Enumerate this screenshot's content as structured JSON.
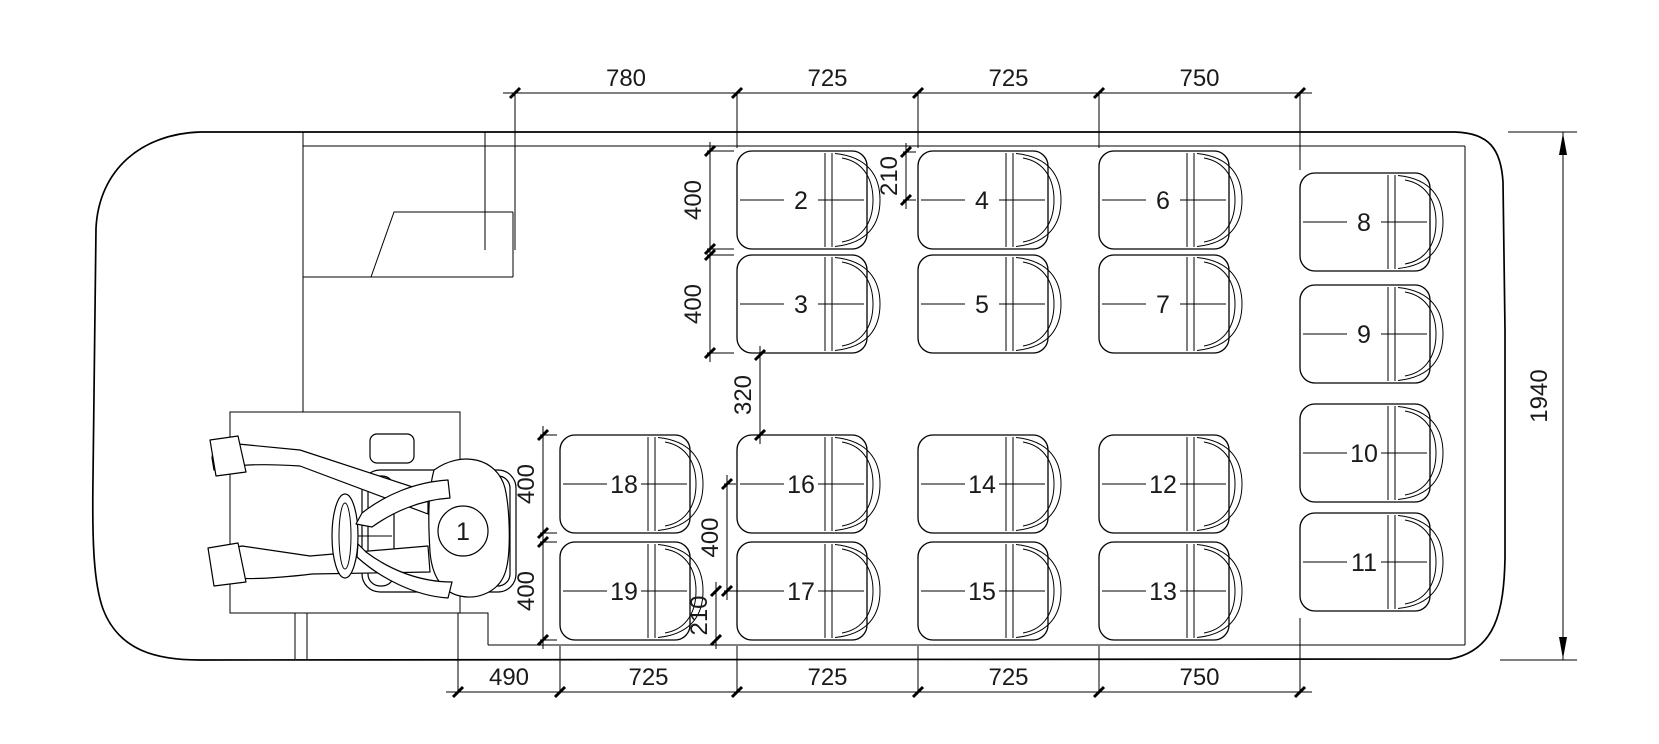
{
  "drawing": {
    "title": "minibus-seating-layout-top-view",
    "seats": {
      "driver": {
        "label": "1"
      },
      "upper_columns": [
        [
          "2",
          "3"
        ],
        [
          "4",
          "5"
        ],
        [
          "6",
          "7"
        ]
      ],
      "rear_column": [
        "8",
        "9",
        "10",
        "11"
      ],
      "lower_columns": [
        [
          "18",
          "19"
        ],
        [
          "16",
          "17"
        ],
        [
          "14",
          "15"
        ],
        [
          "12",
          "13"
        ]
      ]
    },
    "dimensions": {
      "top_chain": [
        "780",
        "725",
        "725",
        "750"
      ],
      "bottom_chain": [
        "490",
        "725",
        "725",
        "725",
        "750"
      ],
      "overall_width": "1940",
      "internal": [
        {
          "id": "seat2-depth",
          "label": "400"
        },
        {
          "id": "seat3-depth",
          "label": "400"
        },
        {
          "id": "seat4-setback",
          "label": "210"
        },
        {
          "id": "row-gap",
          "label": "320"
        },
        {
          "id": "seat18-depth",
          "label": "400"
        },
        {
          "id": "seat19-depth",
          "label": "400"
        },
        {
          "id": "seat16-17-pitch",
          "label": "400"
        },
        {
          "id": "seat17-setback",
          "label": "210"
        }
      ]
    }
  }
}
